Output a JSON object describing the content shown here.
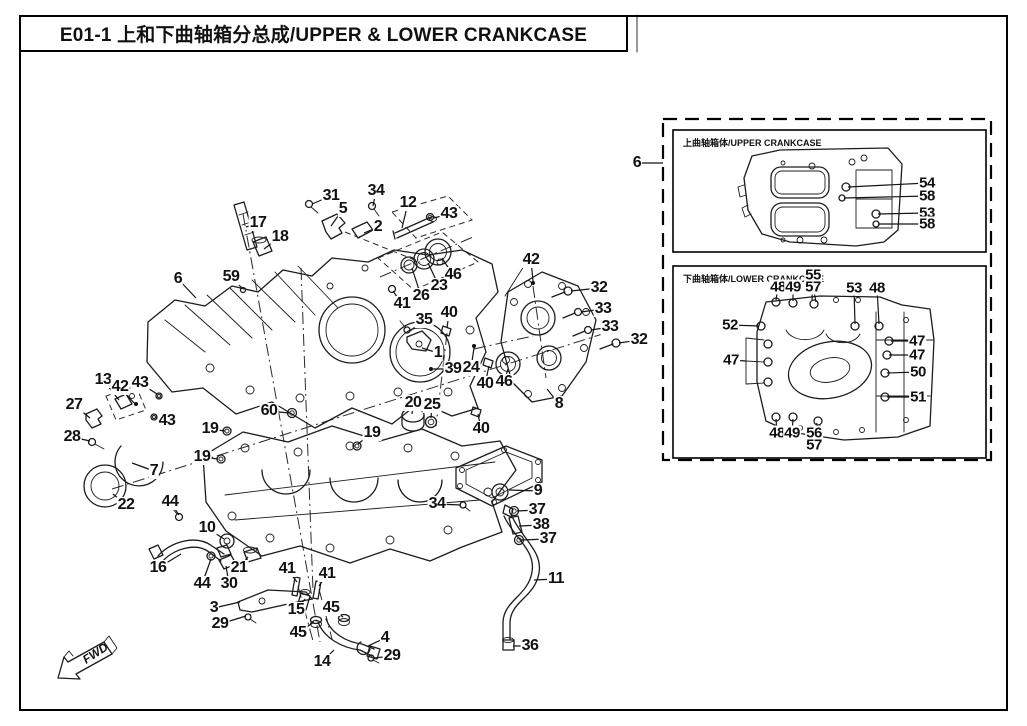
{
  "page": {
    "title": "E01-1  上和下曲轴箱分总成/UPPER & LOWER CRANKCASE",
    "fwd_label": "FWD"
  },
  "colors": {
    "ink": "#1c1c1c",
    "paper": "#ffffff"
  },
  "insets": {
    "upper": {
      "label": "上曲轴箱体/UPPER CRANKCASE"
    },
    "lower": {
      "label": "下曲轴箱体/LOWER CRANKCASE"
    }
  },
  "callouts": {
    "main": [
      {
        "n": "31",
        "x": 331,
        "y": 196,
        "tx": 312,
        "ty": 204
      },
      {
        "n": "34",
        "x": 376,
        "y": 191,
        "tx": 373,
        "ty": 206
      },
      {
        "n": "12",
        "x": 408,
        "y": 203,
        "tx": 402,
        "ty": 228
      },
      {
        "n": "43",
        "x": 449,
        "y": 214,
        "tx": 434,
        "ty": 218
      },
      {
        "n": "5",
        "x": 343,
        "y": 209,
        "tx": 331,
        "ty": 226
      },
      {
        "n": "2",
        "x": 378,
        "y": 227,
        "tx": 364,
        "ty": 233
      },
      {
        "n": "17",
        "x": 258,
        "y": 223,
        "tx": 246,
        "ty": 227
      },
      {
        "n": "18",
        "x": 280,
        "y": 237,
        "tx": 264,
        "ty": 249
      },
      {
        "n": "59",
        "x": 231,
        "y": 277,
        "tx": 242,
        "ty": 288
      },
      {
        "n": "6",
        "x": 178,
        "y": 279,
        "tx": 196,
        "ty": 298
      },
      {
        "n": "46",
        "x": 453,
        "y": 275,
        "tx": 442,
        "ty": 258
      },
      {
        "n": "23",
        "x": 439,
        "y": 286,
        "tx": 428,
        "ty": 263
      },
      {
        "n": "26",
        "x": 421,
        "y": 296,
        "tx": 412,
        "ty": 268
      },
      {
        "n": "41",
        "x": 402,
        "y": 304,
        "tx": 393,
        "ty": 291
      },
      {
        "n": "40",
        "x": 449,
        "y": 313,
        "tx": 447,
        "ty": 328
      },
      {
        "n": "35",
        "x": 424,
        "y": 320,
        "tx": 410,
        "ty": 331
      },
      {
        "n": "1",
        "x": 438,
        "y": 353,
        "tx": 422,
        "ty": 348
      },
      {
        "n": "39",
        "x": 453,
        "y": 369,
        "tx": 433,
        "ty": 369
      },
      {
        "n": "24",
        "x": 471,
        "y": 368,
        "tx": 474,
        "ty": 348
      },
      {
        "n": "42",
        "x": 531,
        "y": 260,
        "tx": 533,
        "ty": 281
      },
      {
        "n": "32",
        "x": 599,
        "y": 288,
        "tx": 571,
        "ty": 291
      },
      {
        "n": "33",
        "x": 603,
        "y": 309,
        "tx": 581,
        "ty": 312
      },
      {
        "n": "33",
        "x": 610,
        "y": 327,
        "tx": 591,
        "ty": 330
      },
      {
        "n": "32",
        "x": 639,
        "y": 340,
        "tx": 619,
        "ty": 343
      },
      {
        "n": "40",
        "x": 485,
        "y": 384,
        "tx": 489,
        "ty": 366
      },
      {
        "n": "46",
        "x": 504,
        "y": 382,
        "tx": 508,
        "ty": 369
      },
      {
        "n": "8",
        "x": 559,
        "y": 404,
        "tx": 547,
        "ty": 389
      },
      {
        "n": "40",
        "x": 481,
        "y": 429,
        "tx": 478,
        "ty": 414
      },
      {
        "n": "13",
        "x": 103,
        "y": 380,
        "tx": 119,
        "ty": 400
      },
      {
        "n": "42",
        "x": 120,
        "y": 387,
        "tx": 134,
        "ty": 403
      },
      {
        "n": "43",
        "x": 140,
        "y": 383,
        "tx": 157,
        "ty": 394
      },
      {
        "n": "27",
        "x": 74,
        "y": 405,
        "tx": 90,
        "ty": 418
      },
      {
        "n": "43",
        "x": 167,
        "y": 421,
        "tx": 156,
        "ty": 417
      },
      {
        "n": "28",
        "x": 72,
        "y": 437,
        "tx": 90,
        "ty": 441
      },
      {
        "n": "7",
        "x": 154,
        "y": 471,
        "tx": 132,
        "ty": 463
      },
      {
        "n": "22",
        "x": 126,
        "y": 505,
        "tx": 113,
        "ty": 494
      },
      {
        "n": "19",
        "x": 210,
        "y": 429,
        "tx": 225,
        "ty": 431
      },
      {
        "n": "19",
        "x": 202,
        "y": 457,
        "tx": 218,
        "ty": 459
      },
      {
        "n": "60",
        "x": 269,
        "y": 411,
        "tx": 289,
        "ty": 413
      },
      {
        "n": "19",
        "x": 372,
        "y": 433,
        "tx": 358,
        "ty": 444
      },
      {
        "n": "20",
        "x": 413,
        "y": 403,
        "tx": 412,
        "ty": 414
      },
      {
        "n": "25",
        "x": 432,
        "y": 405,
        "tx": 431,
        "ty": 418
      },
      {
        "n": "10",
        "x": 207,
        "y": 528,
        "tx": 224,
        "ty": 539
      },
      {
        "n": "16",
        "x": 158,
        "y": 568,
        "tx": 181,
        "ty": 554
      },
      {
        "n": "44",
        "x": 170,
        "y": 502,
        "tx": 179,
        "ty": 515
      },
      {
        "n": "44",
        "x": 202,
        "y": 584,
        "tx": 211,
        "ty": 559
      },
      {
        "n": "30",
        "x": 229,
        "y": 584,
        "tx": 226,
        "ty": 566
      },
      {
        "n": "21",
        "x": 239,
        "y": 568,
        "tx": 248,
        "ty": 557
      },
      {
        "n": "3",
        "x": 214,
        "y": 608,
        "tx": 240,
        "ty": 602
      },
      {
        "n": "29",
        "x": 220,
        "y": 624,
        "tx": 246,
        "ty": 616
      },
      {
        "n": "41",
        "x": 287,
        "y": 569,
        "tx": 297,
        "ty": 582
      },
      {
        "n": "41",
        "x": 327,
        "y": 574,
        "tx": 319,
        "ty": 586
      },
      {
        "n": "15",
        "x": 296,
        "y": 610,
        "tx": 305,
        "ty": 599
      },
      {
        "n": "45",
        "x": 331,
        "y": 608,
        "tx": 343,
        "ty": 617
      },
      {
        "n": "45",
        "x": 298,
        "y": 633,
        "tx": 314,
        "ty": 622
      },
      {
        "n": "14",
        "x": 322,
        "y": 662,
        "tx": 334,
        "ty": 650
      },
      {
        "n": "4",
        "x": 385,
        "y": 638,
        "tx": 368,
        "ty": 646
      },
      {
        "n": "29",
        "x": 392,
        "y": 656,
        "tx": 374,
        "ty": 658
      },
      {
        "n": "34",
        "x": 437,
        "y": 504,
        "tx": 461,
        "ty": 505
      },
      {
        "n": "9",
        "x": 538,
        "y": 491,
        "tx": 509,
        "ty": 490
      },
      {
        "n": "37",
        "x": 537,
        "y": 510,
        "tx": 517,
        "ty": 511
      },
      {
        "n": "38",
        "x": 541,
        "y": 525,
        "tx": 519,
        "ty": 526
      },
      {
        "n": "37",
        "x": 548,
        "y": 539,
        "tx": 521,
        "ty": 540
      },
      {
        "n": "11",
        "x": 556,
        "y": 579,
        "tx": 534,
        "ty": 580
      },
      {
        "n": "36",
        "x": 530,
        "y": 646,
        "tx": 513,
        "ty": 646
      },
      {
        "n": "6",
        "x": 637,
        "y": 163,
        "tx": 663,
        "ty": 163
      }
    ],
    "upper_inset": [
      {
        "n": "54",
        "x": 927,
        "y": 183,
        "tx": 848,
        "ty": 187
      },
      {
        "n": "58",
        "x": 927,
        "y": 196,
        "tx": 844,
        "ty": 198
      },
      {
        "n": "53",
        "x": 927,
        "y": 213,
        "tx": 878,
        "ty": 214
      },
      {
        "n": "58",
        "x": 927,
        "y": 224,
        "tx": 878,
        "ty": 224
      }
    ],
    "lower_inset": [
      {
        "n": "48",
        "x": 778,
        "y": 287,
        "tx": 776,
        "ty": 300
      },
      {
        "n": "49",
        "x": 793,
        "y": 287,
        "tx": 793,
        "ty": 301
      },
      {
        "n": "55",
        "x": 813,
        "y": 275,
        "tx": 812,
        "ty": 300
      },
      {
        "n": "57",
        "x": 813,
        "y": 287,
        "tx": 816,
        "ty": 302
      },
      {
        "n": "53",
        "x": 854,
        "y": 288,
        "tx": 855,
        "ty": 324
      },
      {
        "n": "48",
        "x": 877,
        "y": 288,
        "tx": 879,
        "ty": 324
      },
      {
        "n": "52",
        "x": 730,
        "y": 325,
        "tx": 759,
        "ty": 326
      },
      {
        "n": "47",
        "x": 731,
        "y": 360,
        "tx": 746,
        "ty": 361
      },
      {
        "n": "47",
        "x": 917,
        "y": 341,
        "tx": 891,
        "ty": 341
      },
      {
        "n": "47",
        "x": 917,
        "y": 355,
        "tx": 889,
        "ty": 355
      },
      {
        "n": "50",
        "x": 918,
        "y": 372,
        "tx": 887,
        "ty": 373
      },
      {
        "n": "51",
        "x": 918,
        "y": 397,
        "tx": 887,
        "ty": 397
      },
      {
        "n": "48",
        "x": 777,
        "y": 433,
        "tx": 776,
        "ty": 419
      },
      {
        "n": "49",
        "x": 792,
        "y": 433,
        "tx": 793,
        "ty": 419
      },
      {
        "n": "56",
        "x": 814,
        "y": 433,
        "tx": 817,
        "ty": 423
      },
      {
        "n": "57",
        "x": 814,
        "y": 445,
        "tx": 820,
        "ty": 425
      }
    ]
  }
}
